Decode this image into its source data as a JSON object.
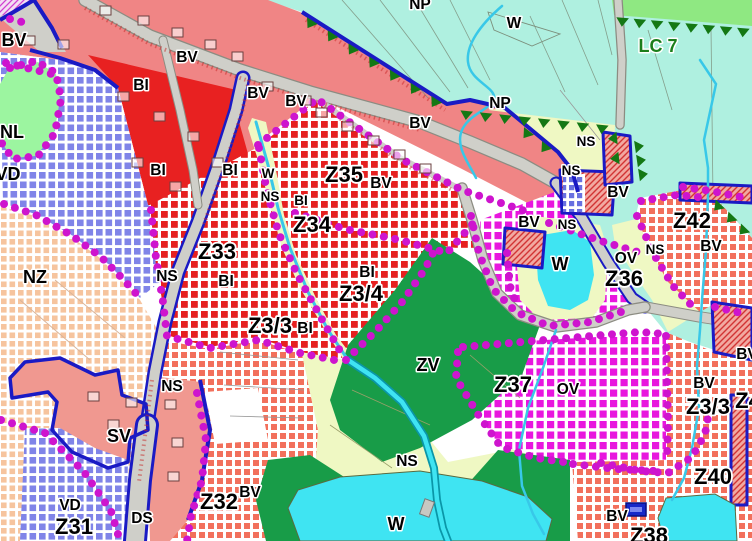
{
  "title": "zoning-plan-map",
  "palette": {
    "bg": "#FFFFFF",
    "pink": "#F08585",
    "sv_pink": "#F09890",
    "red_solid": "#E82121",
    "turquoise": "#AFF0E0",
    "lc_green": "#8FE882",
    "nl_green": "#9CF5A0",
    "zv_green": "#189C48",
    "dark_green": "#147814",
    "yellow": "#EFF8C3",
    "pond": "#3FE4F2",
    "road": "#CFCFC9",
    "road_edge": "#8C8C82",
    "blue": "#1A1AC4",
    "dots": "#CE14CE",
    "checker_red": "#E62020",
    "checker_salmon": "#F2705C",
    "checker_magenta": "#E816DE",
    "checker_peach": "#F6C49E",
    "checker_blue": "#8084E8",
    "stream": "#38C8E8",
    "stream_dark": "#0A96A8",
    "hatch_red": "#D23434",
    "hatch_bg": "#F2A8A0",
    "label": "#000000",
    "halo": "#FFFFFF",
    "lc_text": "#1B7E1B",
    "symbol_blue": "#1628C8"
  },
  "labels": [
    {
      "id": "label-np-top",
      "text": "NP",
      "x": 420,
      "y": 9,
      "cls": "M"
    },
    {
      "id": "label-w-top",
      "text": "W",
      "x": 514,
      "y": 28,
      "cls": "M"
    },
    {
      "id": "label-lc7",
      "text": "LC 7",
      "x": 658,
      "y": 52,
      "cls": "L lc"
    },
    {
      "id": "label-np-right",
      "text": "NP",
      "x": 500,
      "y": 108,
      "cls": "M"
    },
    {
      "id": "label-bv-topleft",
      "text": "BV",
      "x": 14,
      "y": 46,
      "cls": "L"
    },
    {
      "id": "label-bv-1",
      "text": "BV",
      "x": 187,
      "y": 62,
      "cls": "M"
    },
    {
      "id": "label-bi-top",
      "text": "BI",
      "x": 141,
      "y": 90,
      "cls": "M"
    },
    {
      "id": "label-bv-2",
      "text": "BV",
      "x": 258,
      "y": 98,
      "cls": "M"
    },
    {
      "id": "label-bv-3",
      "text": "BV",
      "x": 296,
      "y": 106,
      "cls": "M"
    },
    {
      "id": "label-bv-4",
      "text": "BV",
      "x": 420,
      "y": 128,
      "cls": "M"
    },
    {
      "id": "label-nl",
      "text": "NL",
      "x": 12,
      "y": 138,
      "cls": "L"
    },
    {
      "id": "label-ns-wedge1",
      "text": "NS",
      "x": 586,
      "y": 146,
      "cls": "S"
    },
    {
      "id": "label-ns-wedge2",
      "text": "NS",
      "x": 571,
      "y": 175,
      "cls": "S"
    },
    {
      "id": "label-bi-2",
      "text": "BI",
      "x": 158,
      "y": 175,
      "cls": "M"
    },
    {
      "id": "label-bi-3",
      "text": "BI",
      "x": 230,
      "y": 175,
      "cls": "M"
    },
    {
      "id": "label-w-mid",
      "text": "W",
      "x": 268,
      "y": 178,
      "cls": "S"
    },
    {
      "id": "label-ns-mid",
      "text": "NS",
      "x": 270,
      "y": 201,
      "cls": "S"
    },
    {
      "id": "label-bi-4",
      "text": "BI",
      "x": 301,
      "y": 205,
      "cls": "S"
    },
    {
      "id": "label-z35",
      "text": "Z35",
      "x": 344,
      "y": 182,
      "cls": "XL"
    },
    {
      "id": "label-bv-z35",
      "text": "BV",
      "x": 381,
      "y": 188,
      "cls": "M"
    },
    {
      "id": "label-vd-top",
      "text": "VD",
      "x": 8,
      "y": 180,
      "cls": "L"
    },
    {
      "id": "label-z34",
      "text": "Z34",
      "x": 312,
      "y": 232,
      "cls": "XL"
    },
    {
      "id": "label-bv-p1",
      "text": "BV",
      "x": 618,
      "y": 197,
      "cls": "M"
    },
    {
      "id": "label-z42",
      "text": "Z42",
      "x": 692,
      "y": 228,
      "cls": "XL"
    },
    {
      "id": "label-bv-z42",
      "text": "BV",
      "x": 711,
      "y": 251,
      "cls": "M"
    },
    {
      "id": "label-ns-3",
      "text": "NS",
      "x": 655,
      "y": 254,
      "cls": "S"
    },
    {
      "id": "label-ov-1",
      "text": "OV",
      "x": 626,
      "y": 263,
      "cls": "M"
    },
    {
      "id": "label-w-pond",
      "text": "W",
      "x": 560,
      "y": 270,
      "cls": "L"
    },
    {
      "id": "label-bv-5",
      "text": "BV",
      "x": 529,
      "y": 227,
      "cls": "M"
    },
    {
      "id": "label-ns-4",
      "text": "NS",
      "x": 567,
      "y": 229,
      "cls": "S"
    },
    {
      "id": "label-z36",
      "text": "Z36",
      "x": 624,
      "y": 286,
      "cls": "XL"
    },
    {
      "id": "label-nz",
      "text": "NZ",
      "x": 35,
      "y": 283,
      "cls": "L"
    },
    {
      "id": "label-ns-road",
      "text": "NS",
      "x": 167,
      "y": 281,
      "cls": "M"
    },
    {
      "id": "label-z33",
      "text": "Z33",
      "x": 217,
      "y": 259,
      "cls": "XL"
    },
    {
      "id": "label-bi-z33",
      "text": "BI",
      "x": 226,
      "y": 286,
      "cls": "M"
    },
    {
      "id": "label-bi-5",
      "text": "BI",
      "x": 367,
      "y": 277,
      "cls": "M"
    },
    {
      "id": "label-z3-4",
      "text": "Z3/4",
      "x": 361,
      "y": 301,
      "cls": "XL"
    },
    {
      "id": "label-z3-3-left",
      "text": "Z3/3",
      "x": 270,
      "y": 333,
      "cls": "XL"
    },
    {
      "id": "label-bi-6",
      "text": "BI",
      "x": 305,
      "y": 333,
      "cls": "M"
    },
    {
      "id": "label-zv",
      "text": "ZV",
      "x": 428,
      "y": 371,
      "cls": "L"
    },
    {
      "id": "label-ns-sv",
      "text": "NS",
      "x": 172,
      "y": 391,
      "cls": "M"
    },
    {
      "id": "label-sv",
      "text": "SV",
      "x": 119,
      "y": 442,
      "cls": "L"
    },
    {
      "id": "label-z37",
      "text": "Z37",
      "x": 513,
      "y": 392,
      "cls": "XL"
    },
    {
      "id": "label-ov-2",
      "text": "OV",
      "x": 568,
      "y": 394,
      "cls": "M"
    },
    {
      "id": "label-bv-right-edge",
      "text": "BV",
      "x": 747,
      "y": 359,
      "cls": "M"
    },
    {
      "id": "label-bv-6",
      "text": "BV",
      "x": 704,
      "y": 388,
      "cls": "M"
    },
    {
      "id": "label-z3-3-right",
      "text": "Z3/3",
      "x": 708,
      "y": 414,
      "cls": "XL"
    },
    {
      "id": "label-z41-partial",
      "text": "Z4",
      "x": 748,
      "y": 408,
      "cls": "XL"
    },
    {
      "id": "label-ns-bottom",
      "text": "NS",
      "x": 407,
      "y": 466,
      "cls": "M"
    },
    {
      "id": "label-z40",
      "text": "Z40",
      "x": 713,
      "y": 484,
      "cls": "XL"
    },
    {
      "id": "label-vd-bottom",
      "text": "VD",
      "x": 70,
      "y": 510,
      "cls": "M"
    },
    {
      "id": "label-ds",
      "text": "DS",
      "x": 142,
      "y": 523,
      "cls": "M"
    },
    {
      "id": "label-z31",
      "text": "Z31",
      "x": 74,
      "y": 534,
      "cls": "XL"
    },
    {
      "id": "label-z32",
      "text": "Z32",
      "x": 219,
      "y": 509,
      "cls": "XL"
    },
    {
      "id": "label-bv-z32",
      "text": "BV",
      "x": 250,
      "y": 497,
      "cls": "M"
    },
    {
      "id": "label-w-bottom",
      "text": "W",
      "x": 396,
      "y": 530,
      "cls": "L"
    },
    {
      "id": "label-bv-bottom",
      "text": "BV",
      "x": 617,
      "y": 521,
      "cls": "M"
    },
    {
      "id": "label-z38-partial",
      "text": "Z38",
      "x": 649,
      "y": 543,
      "cls": "XL"
    }
  ]
}
